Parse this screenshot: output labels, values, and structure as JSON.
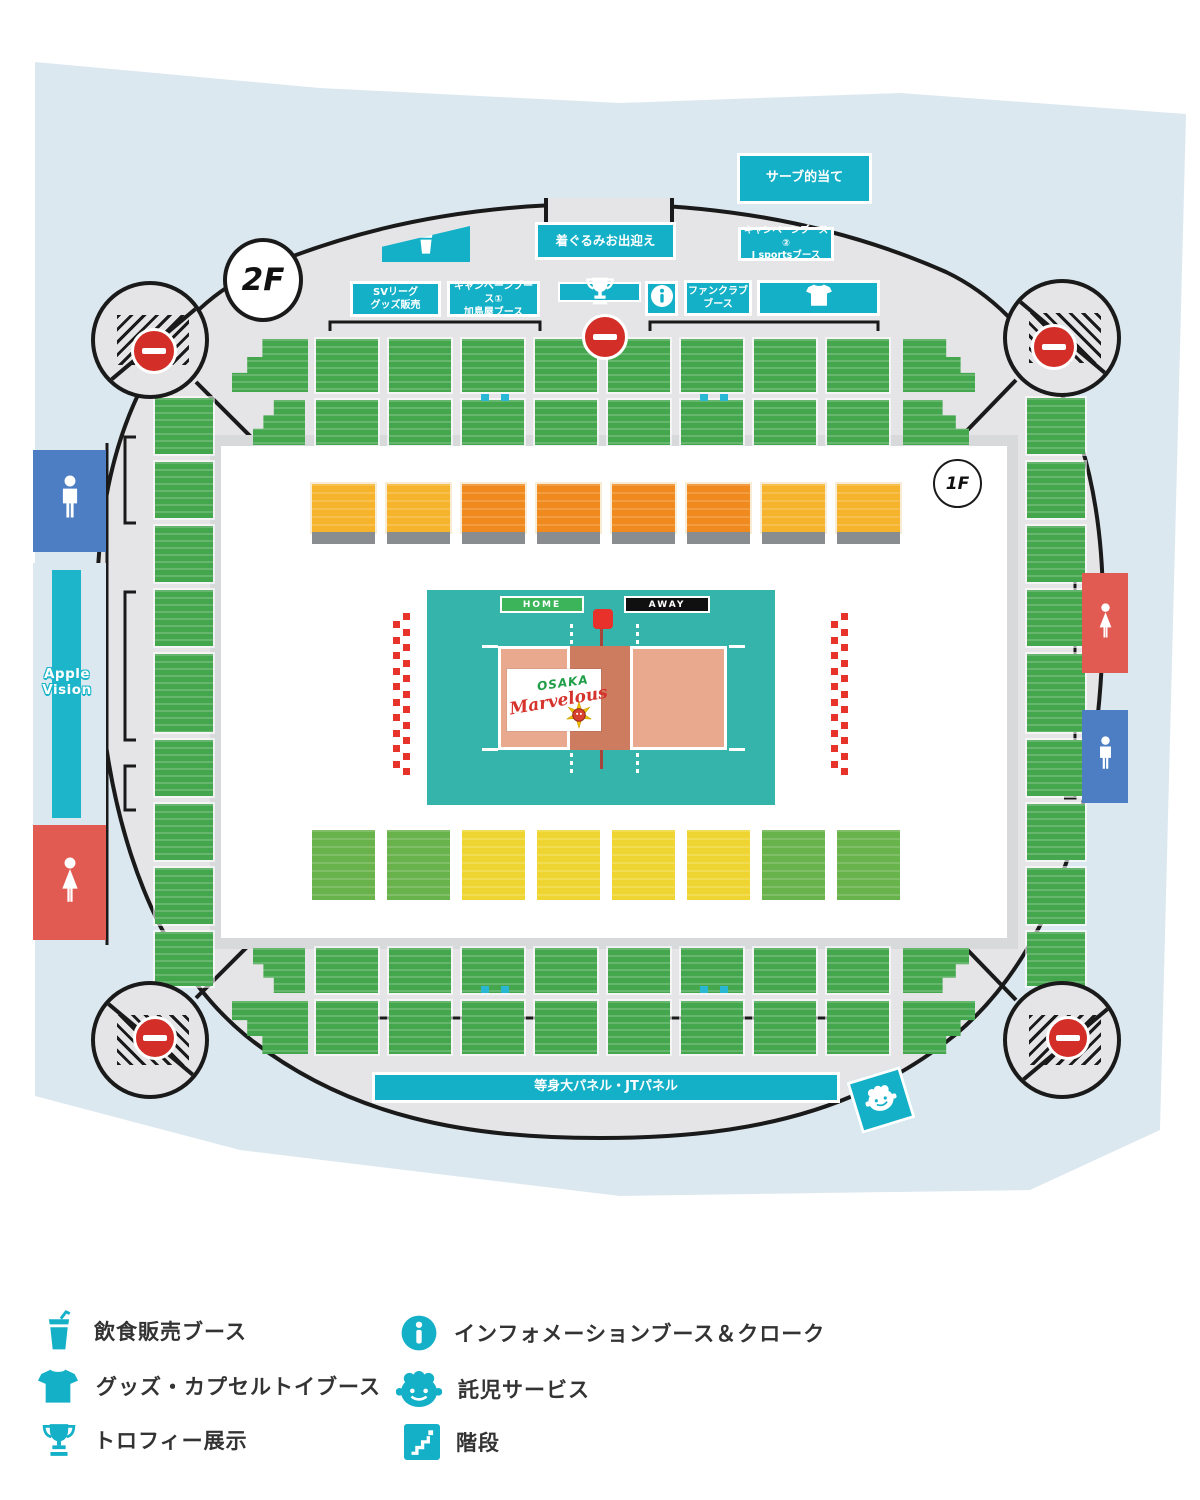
{
  "floors": {
    "upper": "2F",
    "lower": "1F"
  },
  "colors": {
    "cyan": "#14b0c7",
    "background_blue": "#dce8f0",
    "arena_gray": "#e5e5e7",
    "line": "#1a1a1a",
    "seat_green": "#44a64d",
    "seat_amber": "#f6b42c",
    "seat_orange": "#f08a1e",
    "seat_yellow": "#eed531",
    "seat_lime": "#68b34b",
    "court_teal": "#35b4ab",
    "court_sand": "#e9a98e",
    "court_sand_dark": "#cd7c60",
    "home_green": "#3cb45a",
    "away_black": "#101010",
    "no_entry_red": "#d32e27",
    "toilet_blue": "#4d7ec4",
    "toilet_red": "#e25b52",
    "cheer_red": "#e8332a"
  },
  "booths": {
    "serve": {
      "label": "サーブ的当て"
    },
    "kigurumi": {
      "label": "着ぐるみお出迎え"
    },
    "campaign2": {
      "line1": "キャンペーンブース②",
      "line2": "J sportsブース"
    },
    "sv": {
      "line1": "SVリーグ",
      "line2": "グッズ販売"
    },
    "campaign1": {
      "line1": "キャンペーンブース①",
      "line2": "加島屋ブース"
    },
    "fanclub": {
      "line1": "ファンクラブ",
      "line2": "ブース"
    },
    "panel": {
      "label": "等身大パネル・JTパネル"
    }
  },
  "facility_icons": [
    "drink-icon",
    "trophy-icon",
    "info-icon",
    "tshirt-icon",
    "childcare-icon",
    "no-entry-icon",
    "stairs-icon",
    "male-toilet-icon",
    "female-toilet-icon"
  ],
  "court": {
    "home_label": "HOME",
    "away_label": "AWAY",
    "logo_city": "OSAKA",
    "logo_name": "Marvelous"
  },
  "signs": {
    "apple_vision_line1": "Apple",
    "apple_vision_line2": "Vision"
  },
  "legend": {
    "left": [
      {
        "icon": "drink-icon",
        "label": "飲食販売ブース"
      },
      {
        "icon": "tshirt-icon",
        "label": "グッズ・カプセルトイブース"
      },
      {
        "icon": "trophy-icon",
        "label": "トロフィー展示"
      }
    ],
    "right": [
      {
        "icon": "info-icon",
        "label": "インフォメーションブース＆クローク"
      },
      {
        "icon": "childcare-icon",
        "label": "託児サービス"
      },
      {
        "icon": "stairs-icon",
        "label": "階段"
      }
    ]
  },
  "seating": {
    "green_blocks": [
      [
        232,
        339,
        76,
        53,
        "stepped-tl"
      ],
      [
        316,
        339,
        62,
        53
      ],
      [
        389,
        339,
        62,
        53
      ],
      [
        462,
        339,
        62,
        53
      ],
      [
        535,
        339,
        62,
        53
      ],
      [
        608,
        339,
        62,
        53
      ],
      [
        681,
        339,
        62,
        53
      ],
      [
        754,
        339,
        62,
        53
      ],
      [
        827,
        339,
        62,
        53
      ],
      [
        903,
        339,
        72,
        53,
        "stepped-tr"
      ],
      [
        253,
        400,
        52,
        45,
        "stepped-tl"
      ],
      [
        316,
        400,
        62,
        45
      ],
      [
        389,
        400,
        62,
        45
      ],
      [
        462,
        400,
        62,
        45
      ],
      [
        535,
        400,
        62,
        45
      ],
      [
        608,
        400,
        62,
        45
      ],
      [
        681,
        400,
        62,
        45
      ],
      [
        754,
        400,
        62,
        45
      ],
      [
        827,
        400,
        62,
        45
      ],
      [
        903,
        400,
        66,
        45,
        "stepped-tr"
      ],
      [
        253,
        948,
        52,
        45,
        "stepped-bl"
      ],
      [
        316,
        948,
        62,
        45
      ],
      [
        389,
        948,
        62,
        45
      ],
      [
        462,
        948,
        62,
        45
      ],
      [
        535,
        948,
        62,
        45
      ],
      [
        608,
        948,
        62,
        45
      ],
      [
        681,
        948,
        62,
        45
      ],
      [
        754,
        948,
        62,
        45
      ],
      [
        827,
        948,
        62,
        45
      ],
      [
        903,
        948,
        66,
        45,
        "stepped-br"
      ],
      [
        232,
        1001,
        76,
        53,
        "stepped-bl"
      ],
      [
        316,
        1001,
        62,
        53
      ],
      [
        389,
        1001,
        62,
        53
      ],
      [
        462,
        1001,
        62,
        53
      ],
      [
        535,
        1001,
        62,
        53
      ],
      [
        608,
        1001,
        62,
        53
      ],
      [
        681,
        1001,
        62,
        53
      ],
      [
        754,
        1001,
        62,
        53
      ],
      [
        827,
        1001,
        62,
        53
      ],
      [
        903,
        1001,
        72,
        53,
        "stepped-br"
      ],
      [
        155,
        398,
        58,
        56
      ],
      [
        155,
        462,
        58,
        56
      ],
      [
        155,
        526,
        58,
        56
      ],
      [
        155,
        590,
        58,
        56
      ],
      [
        155,
        654,
        58,
        78
      ],
      [
        155,
        740,
        58,
        56
      ],
      [
        155,
        804,
        58,
        56
      ],
      [
        155,
        868,
        58,
        56
      ],
      [
        155,
        932,
        58,
        54
      ],
      [
        1027,
        398,
        58,
        56
      ],
      [
        1027,
        462,
        58,
        56
      ],
      [
        1027,
        526,
        58,
        56
      ],
      [
        1027,
        590,
        58,
        56
      ],
      [
        1027,
        654,
        58,
        78
      ],
      [
        1027,
        740,
        58,
        56
      ],
      [
        1027,
        804,
        58,
        56
      ],
      [
        1027,
        868,
        58,
        56
      ],
      [
        1027,
        932,
        58,
        54
      ]
    ],
    "premium_row": {
      "y": 484,
      "h": 48,
      "w": 63,
      "strip_h": 12,
      "xs": [
        312,
        387,
        462,
        537,
        612,
        687,
        762,
        837
      ],
      "colors": [
        "amber",
        "amber",
        "orange",
        "orange",
        "orange",
        "orange",
        "amber",
        "amber"
      ]
    },
    "lower_row": {
      "y": 830,
      "h": 70,
      "w": 63,
      "xs": [
        312,
        387,
        462,
        537,
        612,
        687,
        762,
        837
      ],
      "colors": [
        "lime",
        "lime",
        "yellow",
        "yellow",
        "yellow",
        "yellow",
        "lime",
        "lime"
      ]
    },
    "wheelchair_spots": [
      [
        481,
        394
      ],
      [
        501,
        394
      ],
      [
        700,
        394
      ],
      [
        720,
        394
      ],
      [
        481,
        986
      ],
      [
        501,
        986
      ],
      [
        700,
        986
      ],
      [
        720,
        986
      ]
    ],
    "cheer_strips": {
      "size": 7,
      "step": 15.5,
      "columns": [
        {
          "x": 393,
          "y": 621,
          "n": 10
        },
        {
          "x": 403,
          "y": 613,
          "n": 11
        },
        {
          "x": 831,
          "y": 621,
          "n": 10
        },
        {
          "x": 841,
          "y": 613,
          "n": 11
        }
      ]
    }
  }
}
